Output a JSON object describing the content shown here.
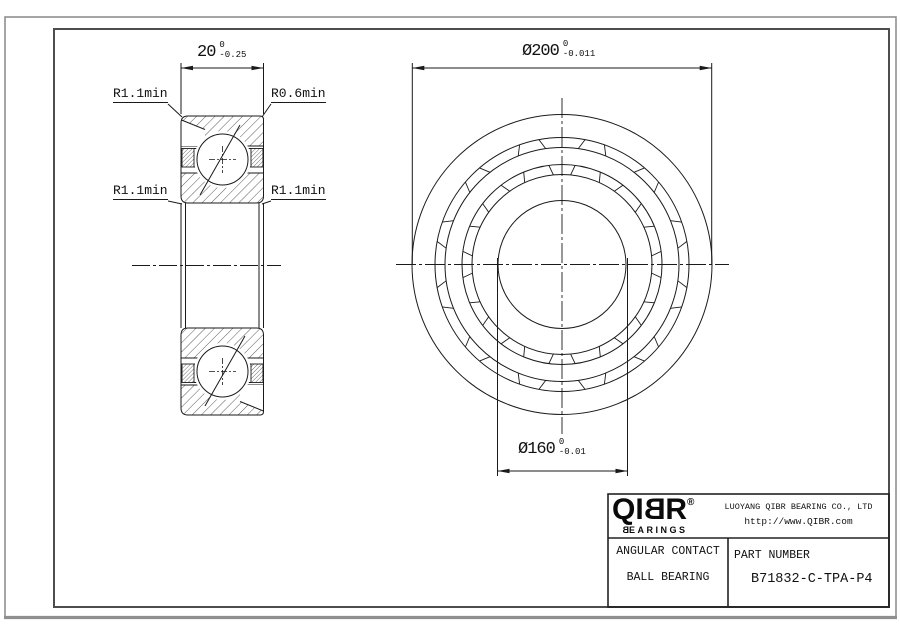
{
  "sheet": {
    "dimensions": {
      "width": {
        "value": "20",
        "tol_top": "0",
        "tol_bottom": "-0.25"
      },
      "outer_diameter": {
        "value": "Ø200",
        "tol_top": "0",
        "tol_bottom": "-0.011"
      },
      "bore_diameter": {
        "value": "Ø160",
        "tol_top": "0",
        "tol_bottom": "-0.01"
      }
    },
    "radius_labels": {
      "top_left": "R1.1min",
      "top_right": "R0.6min",
      "mid_left": "R1.1min",
      "mid_right": "R1.1min"
    }
  },
  "title_block": {
    "logo": {
      "text": "QIBR",
      "registered": "®",
      "subtext": "BEARINGS"
    },
    "company": "LUOYANG QIBR BEARING CO., LTD",
    "website": "http://www.QIBR.com",
    "product_line1": "ANGULAR CONTACT",
    "product_line2": "BALL BEARING",
    "part_label": "PART NUMBER",
    "part_number": "B71832-C-TPA-P4"
  },
  "colors": {
    "line": "#1a1a1a",
    "frame_outer": "#8f8f8f",
    "frame_inner": "#4d4d4d",
    "background": "#ffffff"
  }
}
